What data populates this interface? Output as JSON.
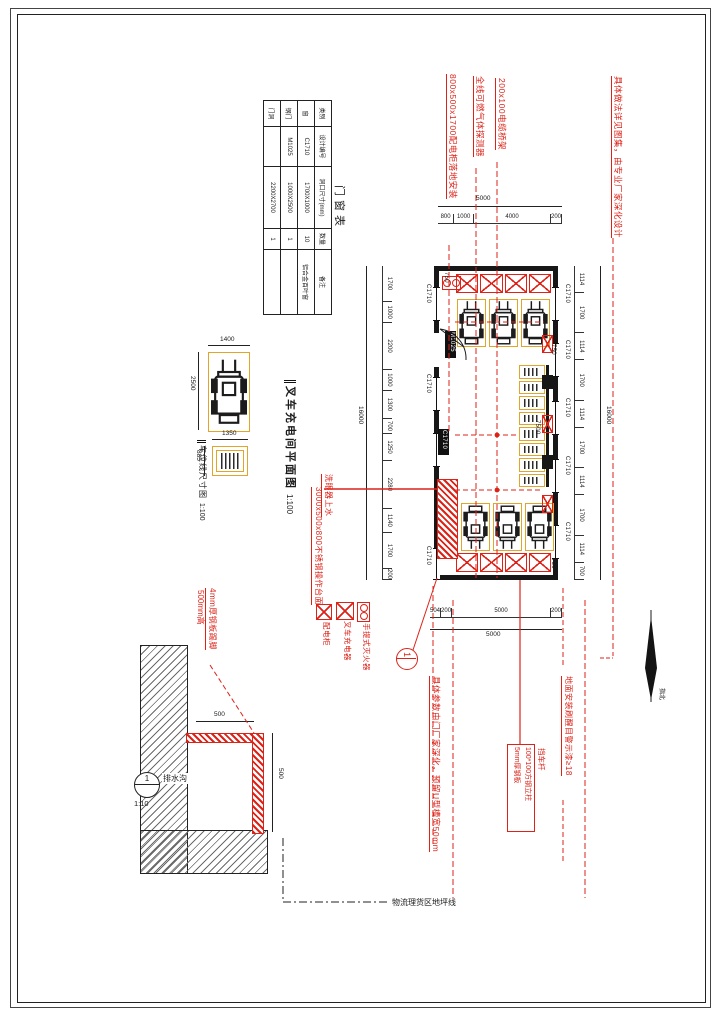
{
  "schedule": {
    "title": "门窗表",
    "headers": [
      "类别",
      "设计编号",
      "洞口尺寸(mm)",
      "数量",
      "备注"
    ],
    "rows": [
      [
        "窗",
        "C1710",
        "1700X1000",
        "10",
        "铝合金百叶窗"
      ],
      [
        "钢门",
        "M1025",
        "1000X2500",
        "1",
        ""
      ],
      [
        "门洞",
        "",
        "2200X2700",
        "1",
        ""
      ]
    ]
  },
  "top_notes": [
    "800x500x1700配电柜落地安装",
    "全线可燃气体探测器",
    "200x100电缆桥架"
  ],
  "right_note": "具体做法详见图集，由专业厂家深化设计",
  "left_notes": {
    "line1": "洗眼器上水",
    "line2": "3000x500x800不锈钢操作台面"
  },
  "plan": {
    "title": "叉车充电间平面图",
    "scale": "1:100",
    "window_tag": "C1710",
    "door_tag": "M1025",
    "rack_dim": "7500",
    "spacing_dim": "750"
  },
  "dims": {
    "top": {
      "overall": "5000",
      "segments": [
        "800",
        "1000",
        "4000",
        "200"
      ]
    },
    "bottom": {
      "overall": "5000",
      "segments": [
        "504",
        "200",
        "5000",
        "200"
      ]
    },
    "left": {
      "overall": "16000",
      "segments": [
        "1700",
        "1000",
        "2200",
        "1000",
        "1300",
        "700",
        "1250",
        "2280",
        "1140",
        "1700",
        "200"
      ]
    },
    "right": {
      "overall": "16000",
      "segments": [
        "1114",
        "1700",
        "1114",
        "1700",
        "1114",
        "1700",
        "1114",
        "1700",
        "1114",
        "700"
      ]
    }
  },
  "legend": [
    {
      "symbol": "x-box-icon",
      "label": "配电柜"
    },
    {
      "symbol": "x-box-icon",
      "label": "叉车充电器"
    },
    {
      "symbol": "fire-extinguisher-icon",
      "label": "手提式灭火器"
    }
  ],
  "parking": {
    "title": "车位线尺寸图",
    "scale": "1:100",
    "stall_width": "1400",
    "stall_depth": "2500",
    "charger_width": "1350",
    "charger_depth": "885"
  },
  "skirting_note": {
    "line1": "4mm厚钢板踢脚",
    "line2": "500mm高"
  },
  "section": {
    "width_dim": "500",
    "height_dim": "500",
    "label": "排水沟",
    "marker": "1",
    "scale": "1:10",
    "floor_line": "物流理货区地坪线"
  },
  "bottom_notes": {
    "door_note": "具体参数由门厂家深化，预留U型槽宽50mm",
    "barrier_label": "挡车杆",
    "barrier_spec": [
      "5mm厚钢板",
      "100*100方钢立柱"
    ],
    "floor_note": "地面安装刷醒目警示漆≥18"
  },
  "north_label": "指北",
  "callout": {
    "number": "1"
  }
}
